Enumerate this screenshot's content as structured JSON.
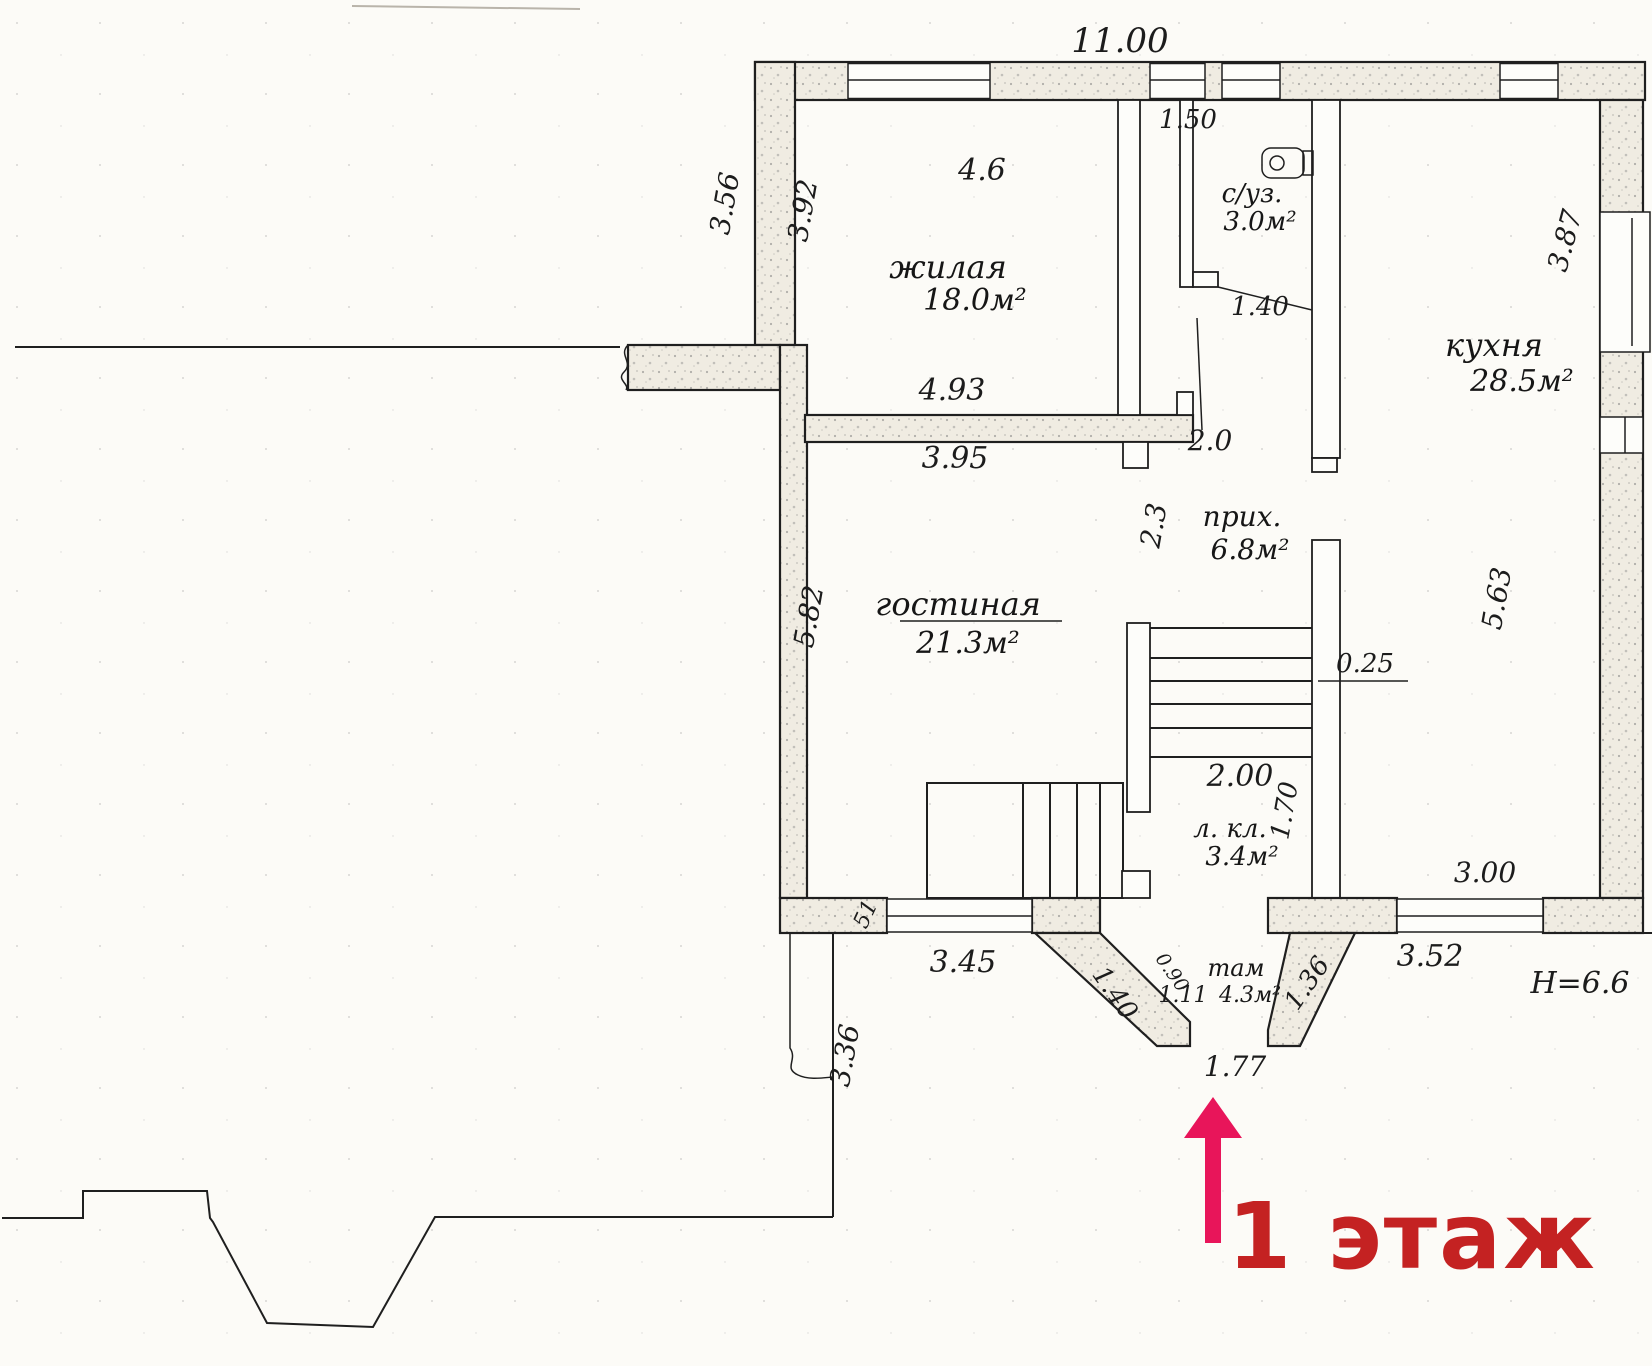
{
  "floor_plan": {
    "floor_label": "1 этаж",
    "colors": {
      "arrow": "#e8155a",
      "floor_label": "#c42222",
      "ink": "#1c1c1c",
      "paper": "#fcfbf7"
    },
    "rooms": [
      {
        "name": "жилая",
        "area": "18.0м²"
      },
      {
        "name": "с/уз.",
        "area": "3.0м²"
      },
      {
        "name": "кухня",
        "area": "28.5м²"
      },
      {
        "name": "прих.",
        "area": "6.8м²"
      },
      {
        "name": "гостиная",
        "area": "21.3м²"
      },
      {
        "name": "л. кл.",
        "area": "3.4м²"
      },
      {
        "name": "там",
        "area": "4.3м²"
      }
    ],
    "dimensions": {
      "top_total": "11.00",
      "zhilaya_width": "4.6",
      "left_outer": "3.56",
      "zhilaya_left": "3.92",
      "suz_width": "1.50",
      "suz_door": "1.40",
      "zhilaya_bottom_a": "4.93",
      "zhilaya_bottom_b": "3.95",
      "prih_opening": "2.0",
      "prih_left": "2.3",
      "kuhnya_right_top": "3.87",
      "kuhnya_right_bottom": "5.63",
      "gostinaya_left": "5.82",
      "wall_thickness": "0.25",
      "stairs_width": "2.00",
      "stairs_depth": "1.70",
      "kuhnya_window": "3.00",
      "corner_wall": "51",
      "gostinaya_window": "3.45",
      "yard_wall": "3.36",
      "tambur_door_left": "1.40",
      "tambur_side": "0.90",
      "tambur_width": "1.11",
      "tambur_door_right": "1.36",
      "bottom_window": "3.52",
      "entrance_width": "1.77",
      "building_height": "H=6.6"
    }
  }
}
